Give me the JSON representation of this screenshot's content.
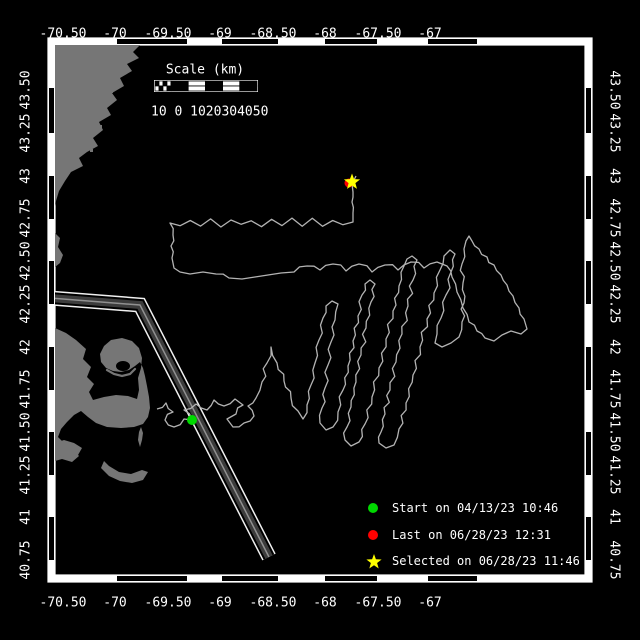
{
  "colors": {
    "background": "#000000",
    "frame_band": "#ffffff",
    "frame_block": "#000000",
    "land": "#767676",
    "track": "#b3b3b3",
    "lane_edge": "#f0f0f0",
    "lane_fill": "#3c3c3c",
    "lane_center": "#909090",
    "text": "#ffffff"
  },
  "axes": {
    "lon": [
      {
        "text": "-70.50",
        "x": 63
      },
      {
        "text": "-70",
        "x": 115
      },
      {
        "text": "-69.50",
        "x": 168
      },
      {
        "text": "-69",
        "x": 220
      },
      {
        "text": "-68.50",
        "x": 273
      },
      {
        "text": "-68",
        "x": 325
      },
      {
        "text": "-67.50",
        "x": 378
      },
      {
        "text": "-67",
        "x": 430
      }
    ],
    "lat": [
      {
        "text": "43.50",
        "y": 90
      },
      {
        "text": "43.25",
        "y": 133
      },
      {
        "text": "43",
        "y": 176
      },
      {
        "text": "42.75",
        "y": 218
      },
      {
        "text": "42.50",
        "y": 261
      },
      {
        "text": "42.25",
        "y": 304
      },
      {
        "text": "42",
        "y": 347
      },
      {
        "text": "41.75",
        "y": 389
      },
      {
        "text": "41.50",
        "y": 432
      },
      {
        "text": "41.25",
        "y": 475
      },
      {
        "text": "41",
        "y": 517
      },
      {
        "text": "40.75",
        "y": 560
      }
    ],
    "top_row_y": 34,
    "bottom_row_y": 603,
    "left_col_x": 26,
    "right_col_x": 614
  },
  "frame": {
    "outer": {
      "x": 48,
      "y": 38,
      "w": 544,
      "h": 544
    },
    "inner": {
      "x": 55,
      "y": 45,
      "w": 530,
      "h": 530
    },
    "h_blocks": [
      [
        117,
        187
      ],
      [
        222,
        278
      ],
      [
        325,
        377
      ],
      [
        428,
        477
      ]
    ],
    "v_blocks": [
      [
        88,
        133
      ],
      [
        176,
        219
      ],
      [
        261,
        304
      ],
      [
        347,
        390
      ],
      [
        432,
        475
      ],
      [
        517,
        560
      ]
    ]
  },
  "scalebar": {
    "title": "Scale (km)",
    "tick_text": "10 0 1020304050",
    "x": 154,
    "y": 80,
    "width": 104,
    "height": 12,
    "checker_cols": 4,
    "checker_width": 18,
    "segments": [
      "black",
      "white",
      "black",
      "white",
      "black"
    ],
    "title_cx": 205,
    "title_cy": 70,
    "text_x": 151,
    "text_cy": 112
  },
  "legend": {
    "marker_x": 373,
    "text_x": 392,
    "rows_y": [
      508,
      535,
      561
    ],
    "items": [
      {
        "marker": "circle",
        "color": "#00d800",
        "label": "Start on 04/13/23 10:46"
      },
      {
        "marker": "circle",
        "color": "#ff0000",
        "label": "Last on 06/28/23 12:31"
      },
      {
        "marker": "star",
        "color": "#ffff00",
        "label": "Selected on 06/28/23 11:46"
      }
    ]
  },
  "land": {
    "polygons": [
      [
        [
          55,
          45
        ],
        [
          140,
          45
        ],
        [
          133,
          52
        ],
        [
          139,
          58
        ],
        [
          127,
          64
        ],
        [
          132,
          71
        ],
        [
          120,
          78
        ],
        [
          124,
          86
        ],
        [
          112,
          93
        ],
        [
          117,
          100
        ],
        [
          107,
          108
        ],
        [
          111,
          115
        ],
        [
          99,
          122
        ],
        [
          103,
          130
        ],
        [
          93,
          138
        ],
        [
          98,
          146
        ],
        [
          87,
          152
        ],
        [
          79,
          158
        ],
        [
          83,
          166
        ],
        [
          71,
          172
        ],
        [
          65,
          181
        ],
        [
          59,
          191
        ],
        [
          56,
          201
        ],
        [
          55,
          206
        ]
      ],
      [
        [
          55,
          233
        ],
        [
          60,
          238
        ],
        [
          58,
          247
        ],
        [
          63,
          255
        ],
        [
          60,
          263
        ],
        [
          55,
          267
        ]
      ],
      [
        [
          55,
          328
        ],
        [
          66,
          333
        ],
        [
          76,
          340
        ],
        [
          86,
          349
        ],
        [
          83,
          359
        ],
        [
          91,
          367
        ],
        [
          87,
          377
        ],
        [
          94,
          384
        ],
        [
          89,
          392
        ],
        [
          93,
          400
        ],
        [
          104,
          397
        ],
        [
          116,
          395
        ],
        [
          128,
          396
        ],
        [
          137,
          399
        ],
        [
          139,
          390
        ],
        [
          138,
          378
        ],
        [
          141,
          368
        ],
        [
          142,
          358
        ],
        [
          139,
          348
        ],
        [
          132,
          341
        ],
        [
          122,
          338
        ],
        [
          111,
          340
        ],
        [
          104,
          346
        ],
        [
          100,
          354
        ],
        [
          101,
          362
        ],
        [
          106,
          368
        ],
        [
          113,
          371
        ],
        [
          121,
          372
        ],
        [
          129,
          370
        ],
        [
          135,
          366
        ],
        [
          140,
          362
        ],
        [
          143,
          368
        ],
        [
          145,
          376
        ],
        [
          147,
          386
        ],
        [
          149,
          397
        ],
        [
          150,
          408
        ],
        [
          148,
          417
        ],
        [
          143,
          424
        ],
        [
          134,
          427
        ],
        [
          121,
          428
        ],
        [
          107,
          427
        ],
        [
          96,
          423
        ],
        [
          88,
          417
        ],
        [
          81,
          411
        ],
        [
          74,
          415
        ],
        [
          67,
          422
        ],
        [
          61,
          429
        ],
        [
          58,
          437
        ],
        [
          64,
          443
        ],
        [
          73,
          449
        ],
        [
          79,
          456
        ],
        [
          72,
          462
        ],
        [
          62,
          459
        ],
        [
          55,
          461
        ]
      ],
      [
        [
          141,
          427
        ],
        [
          143,
          433
        ],
        [
          142,
          440
        ],
        [
          140,
          447
        ],
        [
          138,
          440
        ],
        [
          139,
          432
        ]
      ],
      [
        [
          55,
          443
        ],
        [
          64,
          440
        ],
        [
          74,
          443
        ],
        [
          82,
          448
        ],
        [
          78,
          455
        ],
        [
          67,
          458
        ],
        [
          57,
          454
        ]
      ],
      [
        [
          101,
          468
        ],
        [
          109,
          476
        ],
        [
          120,
          481
        ],
        [
          132,
          483
        ],
        [
          143,
          480
        ],
        [
          148,
          472
        ],
        [
          142,
          470
        ],
        [
          131,
          474
        ],
        [
          119,
          472
        ],
        [
          109,
          466
        ],
        [
          104,
          461
        ]
      ]
    ],
    "harbor_notch": {
      "cx": 123,
      "cy": 366,
      "rx": 7,
      "ry": 5
    },
    "harbor_lip": [
      [
        107,
        370
      ],
      [
        114,
        374
      ],
      [
        122,
        376
      ],
      [
        130,
        374
      ],
      [
        135,
        369
      ]
    ],
    "islets": [
      [
        124,
        58
      ],
      [
        110,
        90
      ],
      [
        99,
        125
      ],
      [
        90,
        149
      ]
    ]
  },
  "lane": {
    "points": [
      [
        50,
        298
      ],
      [
        140,
        305
      ],
      [
        269,
        557
      ]
    ],
    "layers": [
      {
        "w": 15,
        "c": "#f0f0f0"
      },
      {
        "w": 12,
        "c": "#000000"
      },
      {
        "w": 8,
        "c": "#3c3c3c"
      },
      {
        "w": 1.5,
        "c": "#909090"
      }
    ]
  },
  "track": {
    "width": 1.3,
    "segments": [
      {
        "amp": 1.6,
        "period": 7,
        "points": [
          [
            157,
            409
          ],
          [
            166,
            403
          ],
          [
            173,
            412
          ],
          [
            165,
            420
          ],
          [
            174,
            427
          ],
          [
            184,
            419
          ],
          [
            192,
            420
          ],
          [
            184,
            410
          ],
          [
            196,
            404
          ],
          [
            207,
            410
          ],
          [
            214,
            400
          ],
          [
            224,
            406
          ],
          [
            235,
            399
          ],
          [
            243,
            405
          ],
          [
            236,
            414
          ],
          [
            227,
            419
          ],
          [
            233,
            427
          ],
          [
            244,
            423
          ],
          [
            254,
            416
          ],
          [
            248,
            406
          ],
          [
            256,
            398
          ],
          [
            262,
            382
          ],
          [
            267,
            363
          ],
          [
            271,
            347
          ],
          [
            277,
            363
          ],
          [
            284,
            381
          ],
          [
            291,
            398
          ],
          [
            298,
            411
          ],
          [
            303,
            419
          ],
          [
            307,
            405
          ],
          [
            311,
            385
          ],
          [
            315,
            363
          ],
          [
            319,
            340
          ],
          [
            323,
            318
          ],
          [
            326,
            306
          ],
          [
            332,
            301
          ],
          [
            338,
            304
          ],
          [
            335,
            320
          ],
          [
            331,
            342
          ],
          [
            328,
            365
          ],
          [
            325,
            388
          ],
          [
            322,
            408
          ],
          [
            320,
            423
          ],
          [
            326,
            430
          ],
          [
            333,
            427
          ],
          [
            338,
            412
          ],
          [
            343,
            390
          ],
          [
            348,
            366
          ],
          [
            353,
            341
          ],
          [
            358,
            316
          ],
          [
            362,
            295
          ],
          [
            365,
            284
          ],
          [
            370,
            280
          ],
          [
            375,
            284
          ],
          [
            371,
            302
          ],
          [
            366,
            328
          ],
          [
            361,
            355
          ],
          [
            356,
            382
          ],
          [
            351,
            407
          ],
          [
            347,
            427
          ],
          [
            345,
            440
          ],
          [
            351,
            446
          ],
          [
            359,
            442
          ],
          [
            365,
            424
          ],
          [
            372,
            397
          ],
          [
            379,
            368
          ],
          [
            386,
            339
          ],
          [
            393,
            311
          ],
          [
            399,
            286
          ],
          [
            404,
            266
          ],
          [
            407,
            259
          ],
          [
            412,
            256
          ],
          [
            417,
            260
          ],
          [
            413,
            280
          ],
          [
            408,
            306
          ],
          [
            402,
            334
          ],
          [
            396,
            362
          ],
          [
            390,
            390
          ],
          [
            385,
            414
          ],
          [
            381,
            432
          ],
          [
            379,
            443
          ],
          [
            386,
            448
          ],
          [
            394,
            445
          ],
          [
            399,
            429
          ],
          [
            406,
            403
          ],
          [
            413,
            375
          ],
          [
            420,
            347
          ],
          [
            427,
            319
          ],
          [
            434,
            293
          ],
          [
            440,
            270
          ],
          [
            444,
            256
          ],
          [
            450,
            250
          ],
          [
            455,
            254
          ],
          [
            451,
            272
          ],
          [
            446,
            295
          ],
          [
            441,
            318
          ],
          [
            437,
            334
          ],
          [
            435,
            343
          ],
          [
            442,
            347
          ],
          [
            451,
            343
          ],
          [
            459,
            337
          ],
          [
            462,
            322
          ],
          [
            464,
            303
          ],
          [
            463,
            283
          ],
          [
            462,
            264
          ],
          [
            464,
            249
          ],
          [
            466,
            241
          ],
          [
            469,
            236
          ],
          [
            472,
            241
          ],
          [
            479,
            249
          ],
          [
            487,
            257
          ],
          [
            494,
            265
          ],
          [
            501,
            275
          ],
          [
            507,
            285
          ],
          [
            513,
            296
          ],
          [
            519,
            308
          ],
          [
            524,
            319
          ],
          [
            527,
            329
          ],
          [
            521,
            334
          ],
          [
            511,
            331
          ],
          [
            502,
            335
          ],
          [
            494,
            341
          ],
          [
            485,
            338
          ],
          [
            477,
            331
          ],
          [
            469,
            322
          ],
          [
            463,
            308
          ],
          [
            457,
            292
          ],
          [
            452,
            277
          ],
          [
            447,
            266
          ]
        ]
      },
      {
        "amp": 2.2,
        "period": 9,
        "points": [
          [
            437,
            262
          ],
          [
            424,
            268
          ],
          [
            411,
            262
          ],
          [
            398,
            270
          ],
          [
            385,
            265
          ],
          [
            372,
            272
          ],
          [
            359,
            264
          ],
          [
            346,
            271
          ],
          [
            333,
            264
          ],
          [
            320,
            270
          ],
          [
            307,
            266
          ],
          [
            294,
            272
          ],
          [
            281,
            273
          ],
          [
            268,
            275
          ],
          [
            255,
            277
          ],
          [
            242,
            279
          ],
          [
            229,
            278
          ],
          [
            216,
            274
          ],
          [
            203,
            272
          ],
          [
            190,
            274
          ],
          [
            180,
            272
          ],
          [
            174,
            268
          ]
        ]
      },
      {
        "amp": 1.5,
        "period": 7,
        "points": [
          [
            172,
            258
          ],
          [
            171,
            246
          ],
          [
            173,
            235
          ],
          [
            170,
            223
          ]
        ]
      },
      {
        "amp": 3.0,
        "period": 10,
        "points": [
          [
            170,
            223
          ],
          [
            353,
            222
          ]
        ]
      },
      {
        "amp": 1.0,
        "period": 6,
        "points": [
          [
            353,
            213
          ],
          [
            352,
            202
          ],
          [
            353,
            192
          ],
          [
            352,
            184
          ],
          [
            356,
            176
          ]
        ]
      }
    ]
  },
  "markers": {
    "start": {
      "x": 192,
      "y": 420,
      "r": 5,
      "color": "#00d800"
    },
    "last": {
      "x": 349,
      "y": 183,
      "r": 4.5,
      "color": "#ff0000"
    },
    "selected": {
      "x": 352,
      "y": 182,
      "r": 8.5,
      "color": "#ffff00"
    }
  }
}
